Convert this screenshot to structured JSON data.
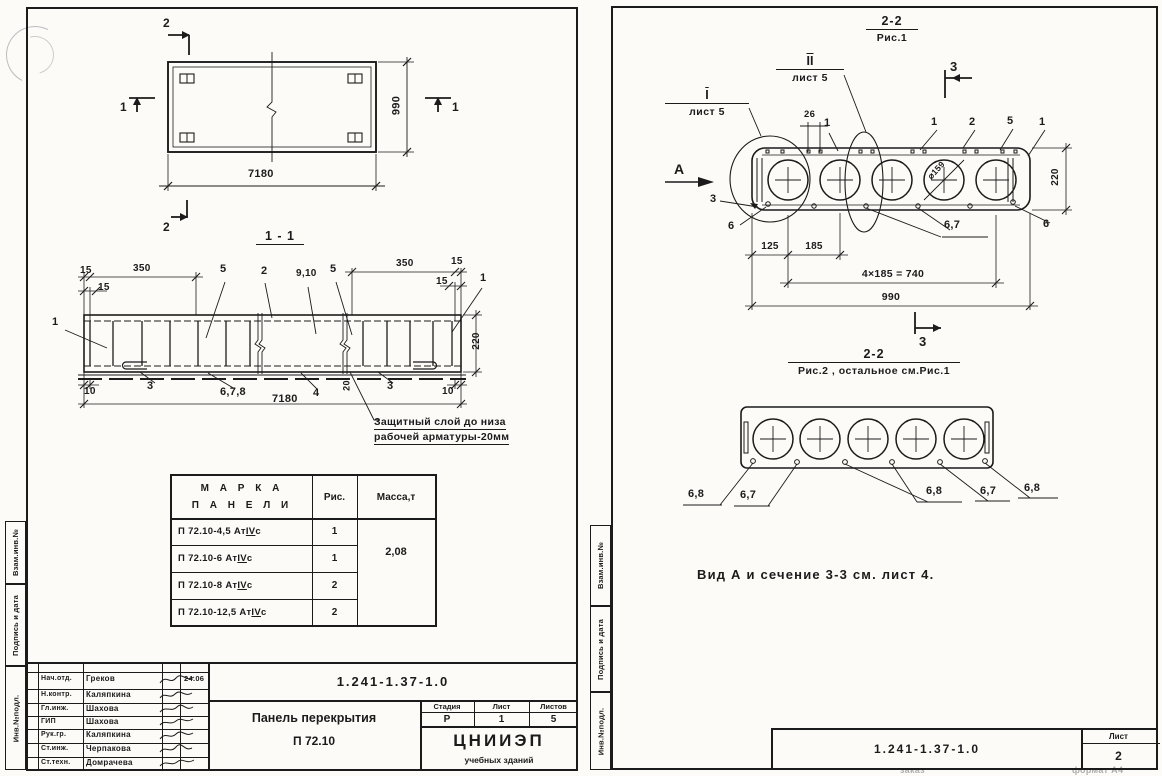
{
  "colors": {
    "ink": "#1b1b1b",
    "paper": "#fcfbf8"
  },
  "strip": [
    "Взам.инв.№",
    "Подпись и дата",
    "Инв.№подл."
  ],
  "left": {
    "plan": {
      "m2t": "2",
      "m2b": "2",
      "m1l": "1",
      "m1r": "1",
      "len": "7180",
      "wid": "990"
    },
    "s11": {
      "h": "1 - 1",
      "d15a": "15",
      "d350a": "350",
      "d15b": "15",
      "l1l": "1",
      "l5a": "5",
      "l2": "2",
      "l910": "9,10",
      "l5b": "5",
      "d350b": "350",
      "d15c": "15",
      "d15d": "15",
      "l1r": "1",
      "d220": "220",
      "d10a": "10",
      "l3a": "3",
      "l678": "6,7,8",
      "d7180": "7180",
      "l4": "4",
      "d20": "20",
      "l3b": "3",
      "d10b": "10",
      "note1": "Защитный слой до низа",
      "note2": "рабочей арматуры-20мм"
    },
    "table": {
      "h1a": "М А Р К А",
      "h1b": "П А Н Е Л И",
      "h2": "Рис.",
      "h3": "Масса,т",
      "rows": [
        {
          "m": "П 72.10-4,5 Ат",
          "iv": "IV",
          "s": "с",
          "f": "1"
        },
        {
          "m": "П 72.10-6 Ат",
          "iv": "IV",
          "s": "с",
          "f": "1"
        },
        {
          "m": "П 72.10-8 Ат",
          "iv": "IV",
          "s": "с",
          "f": "2"
        },
        {
          "m": "П 72.10-12,5 Ат",
          "iv": "IV",
          "s": "с",
          "f": "2"
        }
      ],
      "mass": "2,08"
    },
    "tb": {
      "doc": "1.241-1.37-1.0",
      "rows": [
        {
          "r": "Нач.отд.",
          "n": "Греков"
        },
        {
          "r": "Н.контр.",
          "n": "Каляпкина"
        },
        {
          "r": "Гл.инж.",
          "n": "Шахова"
        },
        {
          "r": "ГИП",
          "n": "Шахова"
        },
        {
          "r": "Рук.гр.",
          "n": "Каляпкина"
        },
        {
          "r": "Ст.инж.",
          "n": "Черпакова"
        },
        {
          "r": "Ст.техн.",
          "n": "Домрачева"
        }
      ],
      "date": "24.06",
      "title1": "Панель перекрытия",
      "title2": "П 72.10",
      "st_h": [
        "Стадия",
        "Лист",
        "Листов"
      ],
      "st_v": [
        "Р",
        "1",
        "5"
      ],
      "org1": "ЦНИИЭП",
      "org2": "учебных зданий"
    }
  },
  "right": {
    "f1": {
      "h": "2-2",
      "sub": "Рис.1",
      "c1a": "I",
      "c1b": "лист 5",
      "c2a": "II",
      "c2b": "лист 5",
      "m3t": "3",
      "m3b": "3",
      "va": "А",
      "l26": "26",
      "l1a": "1",
      "l1b": "1",
      "l2": "2",
      "l5": "5",
      "l1c": "1",
      "l3": "3",
      "l6a": "6",
      "l67": "6,7",
      "l6b": "6",
      "dia": "⌀159",
      "d125": "125",
      "d185": "185",
      "d740": "4×185 = 740",
      "d990": "990",
      "d220": "220"
    },
    "f2": {
      "h": "2-2",
      "sub": "Рис.2 , остальное см.Рис.1",
      "l68a": "6,8",
      "l67a": "6,7",
      "l68b": "6,8",
      "l67b": "6,7",
      "l68c": "6,8"
    },
    "note": "Вид А и сечение 3-3 см. лист 4.",
    "tb": {
      "doc": "1.241-1.37-1.0",
      "sheet_l": "Лист",
      "sheet_v": "2"
    },
    "footer": {
      "z": "заказ",
      "f": "формат А4"
    }
  }
}
